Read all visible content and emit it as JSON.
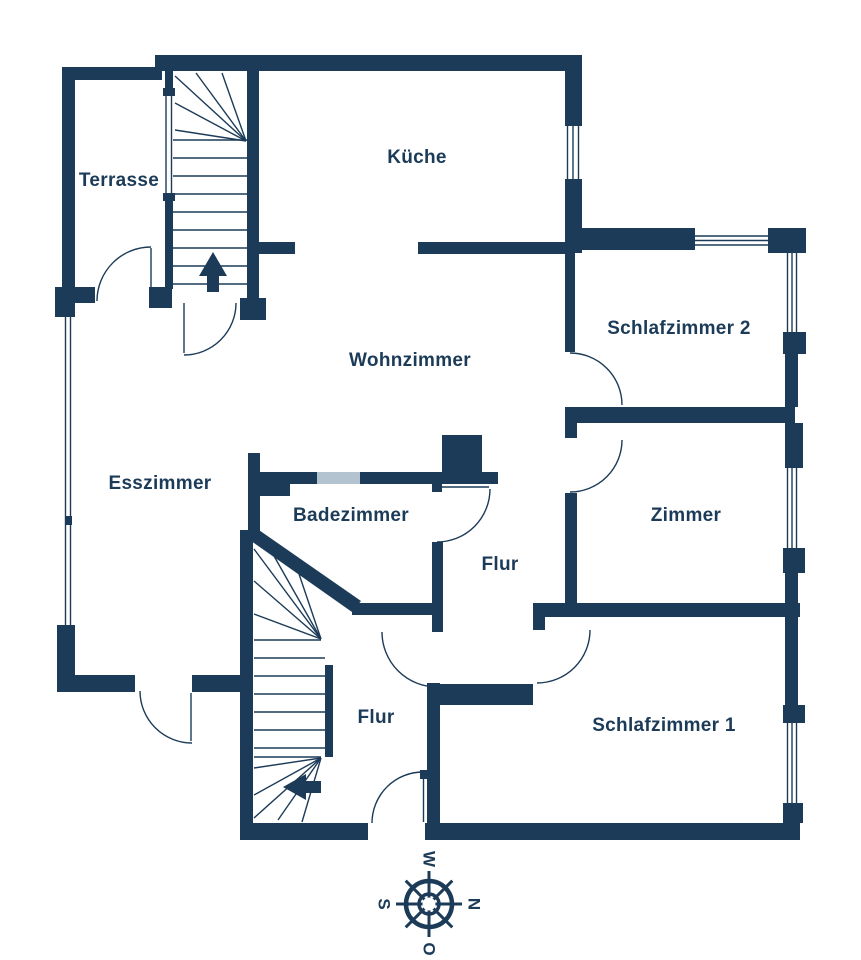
{
  "floorplan": {
    "rooms": [
      {
        "id": "terrasse",
        "label": "Terrasse"
      },
      {
        "id": "kueche",
        "label": "Küche"
      },
      {
        "id": "wohnzimmer",
        "label": "Wohnzimmer"
      },
      {
        "id": "schlafzimmer-2",
        "label": "Schlafzimmer 2"
      },
      {
        "id": "esszimmer",
        "label": "Esszimmer"
      },
      {
        "id": "badezimmer",
        "label": "Badezimmer"
      },
      {
        "id": "flur-oben",
        "label": "Flur"
      },
      {
        "id": "zimmer",
        "label": "Zimmer"
      },
      {
        "id": "flur-unten",
        "label": "Flur"
      },
      {
        "id": "schlafzimmer-1",
        "label": "Schlafzimmer 1"
      }
    ],
    "compass": {
      "north": "N",
      "east": "O",
      "south": "S",
      "west": "W"
    },
    "stairs": [
      {
        "id": "upper-staircase",
        "arrow_direction": "up"
      },
      {
        "id": "lower-staircase",
        "arrow_direction": "left"
      }
    ],
    "colors": {
      "wall": "#1c3b58",
      "glass": "#b4c3d0",
      "background": "#ffffff"
    }
  }
}
